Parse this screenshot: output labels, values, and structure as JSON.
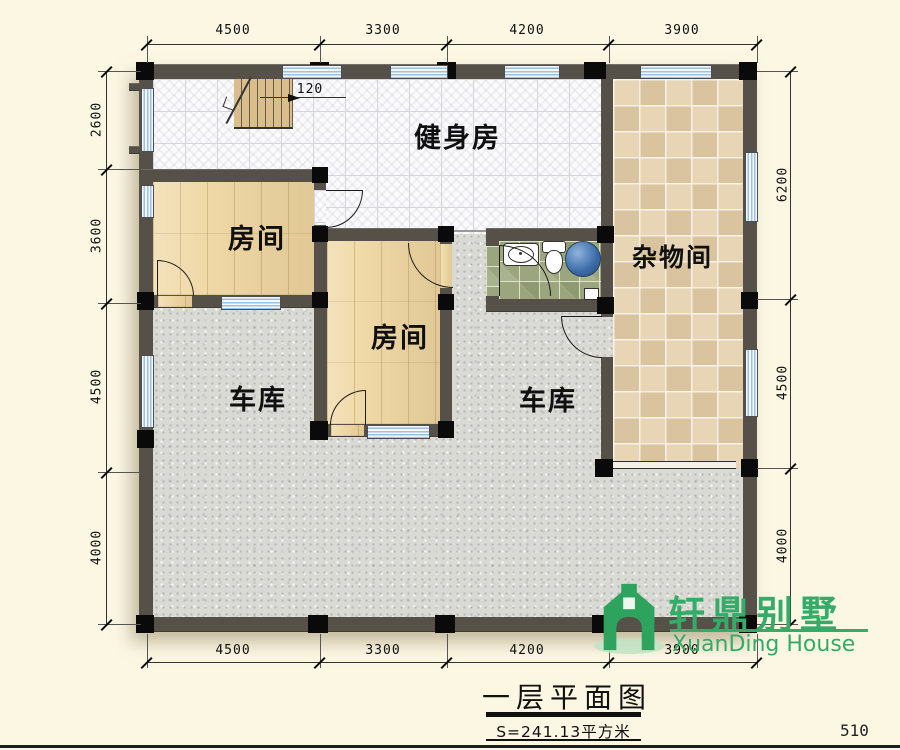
{
  "title_block": {
    "title": "一层平面图",
    "area": "S=241.13平方米",
    "sheet_number": "510"
  },
  "logo": {
    "cn": "轩鼎别墅",
    "en": "XuanDing House",
    "color": "#35ab68"
  },
  "rooms": {
    "gym": "健身房",
    "bedroom1": "房间",
    "bedroom2": "房间",
    "storage": "杂物间",
    "garage_left": "车库",
    "garage_right": "车库"
  },
  "annotations": {
    "stair_width": "120"
  },
  "dimensions": {
    "top": [
      "4500",
      "3300",
      "4200",
      "3900"
    ],
    "bottom": [
      "4500",
      "3300",
      "4200",
      "3900"
    ],
    "left": [
      "2600",
      "3600",
      "4500",
      "4000"
    ],
    "right": [
      "6200",
      "4500",
      "4000"
    ]
  },
  "colors": {
    "background": "#fbf7e3",
    "wall": "#555048",
    "column": "#0a0a0a",
    "wood_floor": "#efd8a5",
    "storage_tile": "#e7d5b5",
    "bathroom_tile": "#9ba67e",
    "garage_floor": "#dadad5",
    "window_blue": "#9dc1de",
    "logo_green": "#35ab68"
  }
}
